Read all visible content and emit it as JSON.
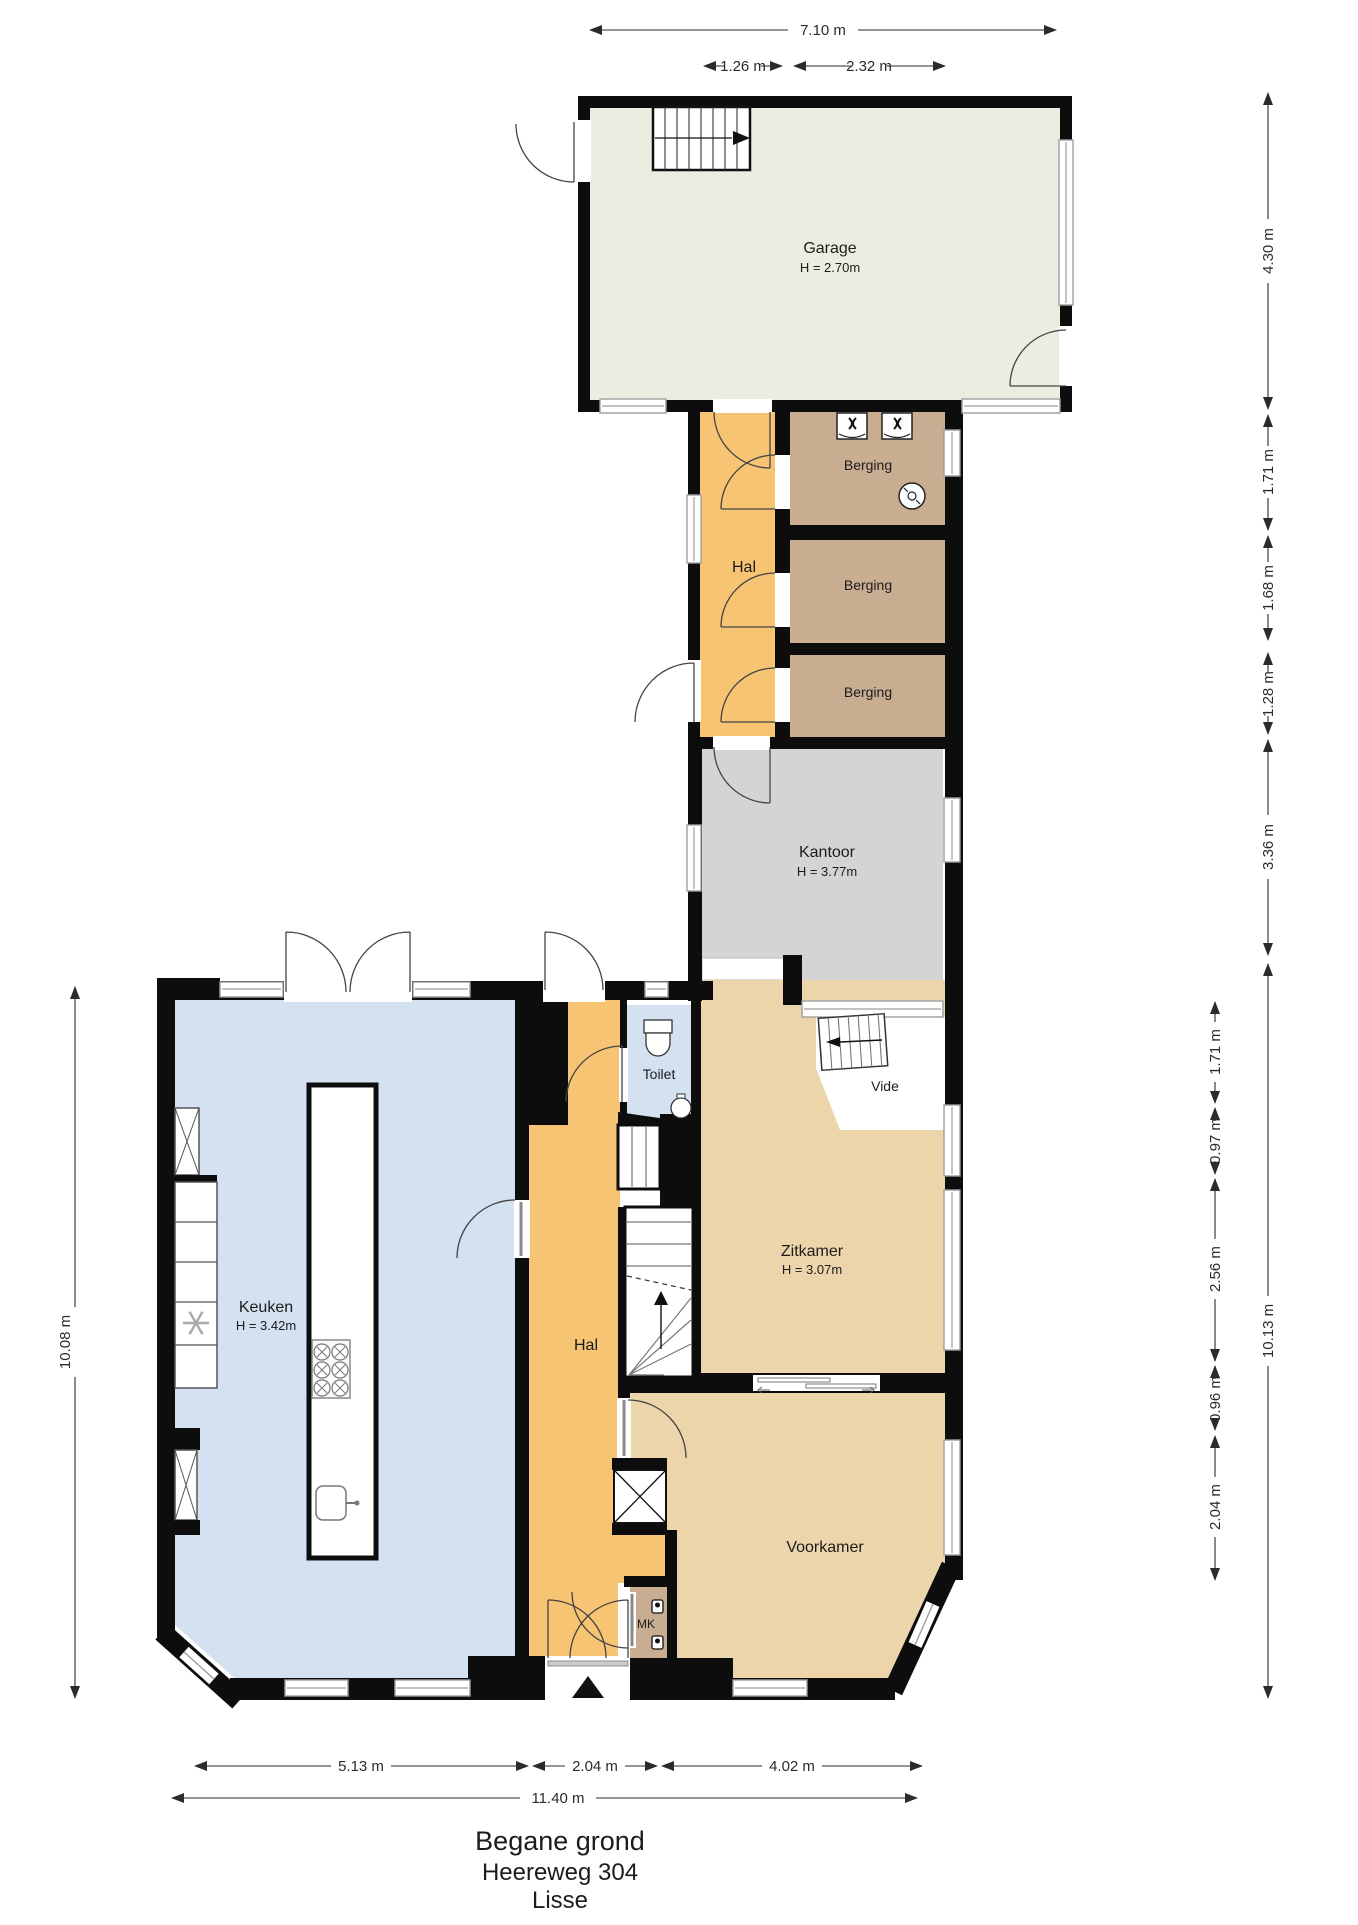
{
  "plan": {
    "title_lines": [
      "Begane grond",
      "Heereweg 304",
      "Lisse"
    ]
  },
  "rooms": {
    "garage": {
      "name": "Garage",
      "height": "H = 2.70m"
    },
    "hal_wing": {
      "name": "Hal"
    },
    "berging_1": {
      "name": "Berging"
    },
    "berging_2": {
      "name": "Berging"
    },
    "berging_3": {
      "name": "Berging"
    },
    "kantoor": {
      "name": "Kantoor",
      "height": "H = 3.77m"
    },
    "keuken": {
      "name": "Keuken",
      "height": "H = 3.42m"
    },
    "toilet": {
      "name": "Toilet"
    },
    "vide": {
      "name": "Vide"
    },
    "zitkamer": {
      "name": "Zitkamer",
      "height": "H = 3.07m"
    },
    "hal_lower": {
      "name": "Hal"
    },
    "voorkamer": {
      "name": "Voorkamer"
    },
    "mk": {
      "name": "MK"
    }
  },
  "dimensions": {
    "top_overall": "7.10 m",
    "top_sub_1": "1.26 m",
    "top_sub_2": "2.32 m",
    "right_upper": [
      "4.30 m",
      "1.71 m",
      "1.68 m",
      "1.28 m",
      "3.36 m"
    ],
    "right_inner": [
      "1.71 m",
      "0.97 m",
      "2.56 m",
      "0.96 m",
      "2.04 m"
    ],
    "right_outer": "10.13 m",
    "left_overall": "10.08 m",
    "bottom_segments": [
      "5.13 m",
      "2.04 m",
      "4.02 m"
    ],
    "bottom_overall": "11.40 m"
  },
  "colors": {
    "wall": "#0d0d0d",
    "garage_fill": "#edece1",
    "hall_fill": "#f6c473",
    "storage_fill": "#c8ad90",
    "office_fill": "#d4d4d4",
    "kitchen_toilet_fill": "#d3e1f0",
    "living_fill": "#edd5ab",
    "window_grey": "#9e9e9e"
  },
  "icons": {
    "entrance_marker": "▲",
    "stair_up_arrow": "arrow",
    "freezer": "snowflake"
  }
}
